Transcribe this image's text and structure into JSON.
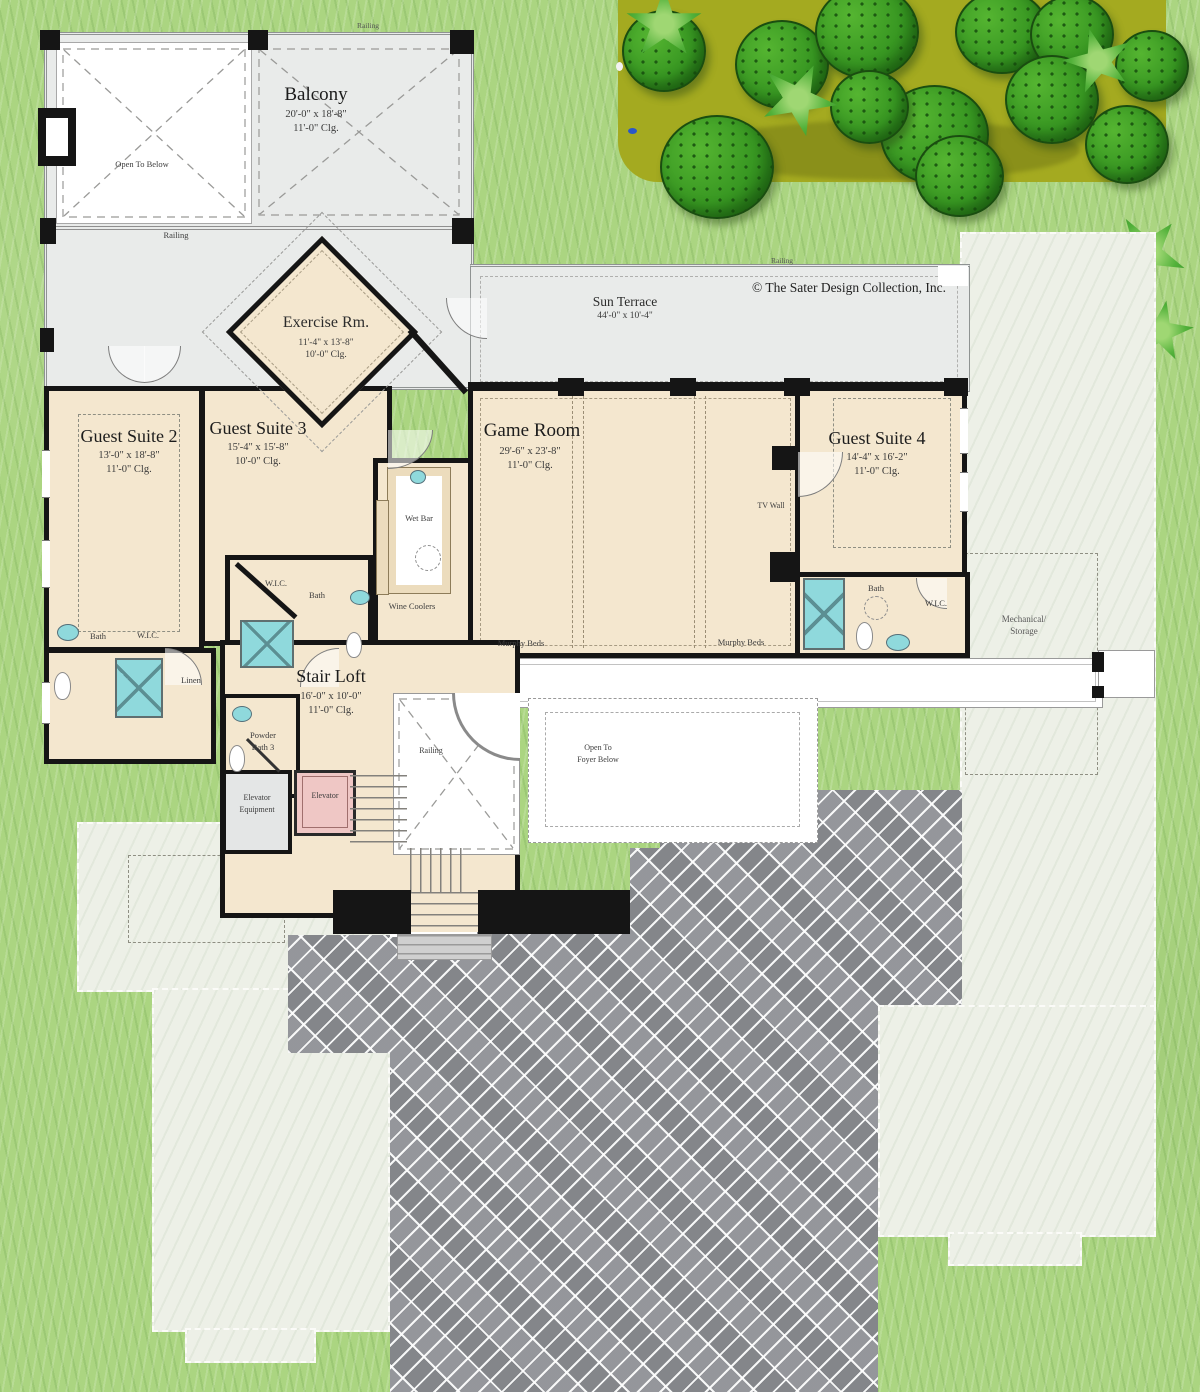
{
  "copyright": "© The Sater Design Collection, Inc.",
  "rooms": {
    "balcony": {
      "name": "Balcony",
      "dim": "20'-0\" x 18'-8\"",
      "clg": "11'-0\" Clg."
    },
    "sun_terrace": {
      "name": "Sun Terrace",
      "dim": "44'-0\" x 10'-4\""
    },
    "exercise": {
      "name": "Exercise Rm.",
      "dim": "11'-4\" x 13'-8\"",
      "clg": "10'-0\" Clg."
    },
    "guest2": {
      "name": "Guest Suite 2",
      "dim": "13'-0\" x 18'-8\"",
      "clg": "11'-0\" Clg."
    },
    "guest3": {
      "name": "Guest Suite 3",
      "dim": "15'-4\" x 15'-8\"",
      "clg": "10'-0\" Clg."
    },
    "game_room": {
      "name": "Game Room",
      "dim": "29'-6\" x 23'-8\"",
      "clg": "11'-0\" Clg."
    },
    "guest4": {
      "name": "Guest Suite 4",
      "dim": "14'-4\" x 16'-2\"",
      "clg": "11'-0\" Clg."
    },
    "stair_loft": {
      "name": "Stair Loft",
      "dim": "16'-0\" x 10'-0\"",
      "clg": "11'-0\" Clg."
    }
  },
  "small_labels": {
    "railing": "Railing",
    "open_to_below": "Open To Below",
    "open_to_foyer_1": "Open To",
    "open_to_foyer_2": "Foyer Below",
    "wet_bar": "Wet Bar",
    "wine_coolers": "Wine Coolers",
    "murphy_beds": "Murphy Beds",
    "tv_wall": "TV Wall",
    "bath": "Bath",
    "wic": "W.I.C.",
    "linen": "Linen",
    "powder_1": "Powder",
    "powder_2": "Bath 3",
    "elevator": "Elevator",
    "elev_equip_1": "Elevator",
    "elev_equip_2": "Equipment",
    "mechanical_1": "Mechanical/",
    "mechanical_2": "Storage"
  },
  "colors": {
    "grass": "#abd581",
    "planting_bed": "#a4aa20",
    "bush": "#389722",
    "roof_light": "#edf0e7",
    "terrace_gray": "#e9ebea",
    "room_beige": "#f4e7cf",
    "wall_black": "#151515",
    "paver_gray": "#8e9095",
    "shower_cyan": "#8fd9dc",
    "elevator_pink": "#efc7c5"
  }
}
